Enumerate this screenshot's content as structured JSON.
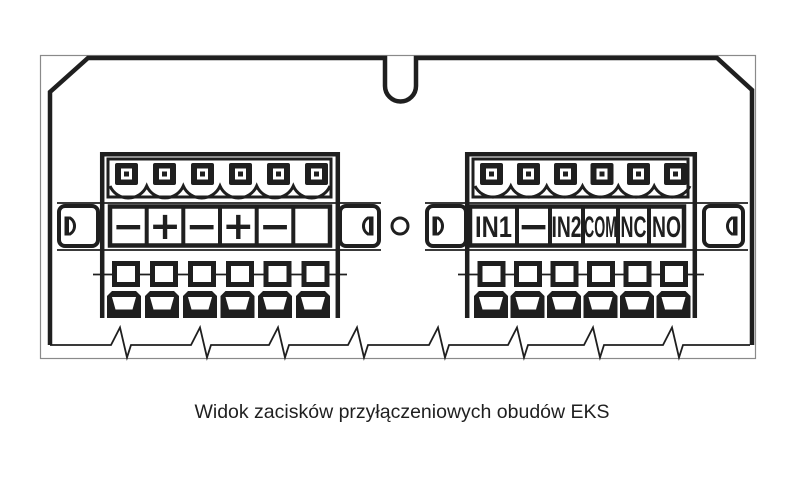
{
  "figure_caption": "Widok zacisków przyłączeniowych obudów EKS",
  "power_terminal_block": {
    "labels": [
      "−",
      "+",
      "−",
      "+",
      "−",
      ""
    ]
  },
  "io_terminal_block": {
    "labels": [
      "IN1",
      "−",
      "IN2",
      "COM",
      "NC",
      "NO"
    ]
  },
  "colors": {
    "line": "#1f1f1f",
    "thin_line": "#8a8a8a",
    "background": "#ffffff"
  }
}
